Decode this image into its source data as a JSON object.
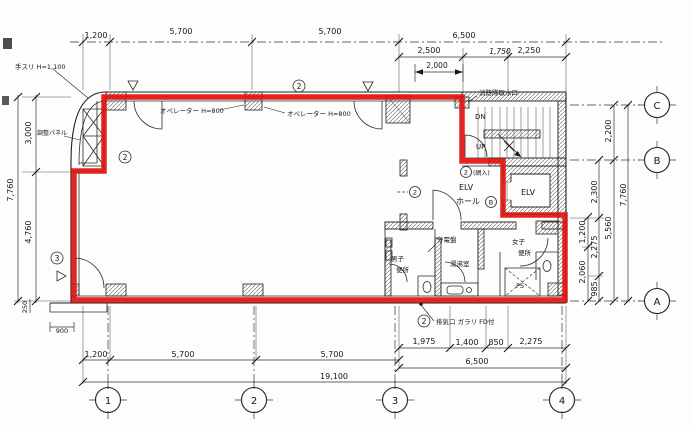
{
  "title": "floor-plan",
  "colors": {
    "leased_outline": "#e0140e",
    "ink": "#1f1f1f"
  },
  "dims": {
    "top": [
      "1,200",
      "5,700",
      "5,700",
      "6,500"
    ],
    "top_sub": [
      "2,500",
      "1,750",
      "2,250"
    ],
    "door_swing": "2,000",
    "left": [
      "3,000",
      "4,760"
    ],
    "left_total": "7,760",
    "step_depth": "250",
    "step_width": "900",
    "bottom_right": [
      "1,975",
      "1,400",
      "850",
      "2,275"
    ],
    "bottom_right_total": "6,500",
    "bottom_left": [
      "1,200",
      "5,700",
      "5,700"
    ],
    "total_width": "19,100",
    "right": {
      "c_to_b": "2,200",
      "upper": "2,300",
      "mid": "1,200",
      "mid2": "2,275",
      "lower": "2,060",
      "lowest": "985",
      "subtotal": "5,560",
      "total": "7,760"
    }
  },
  "grid": {
    "columns": [
      "1",
      "2",
      "3",
      "4"
    ],
    "rows": [
      "C",
      "B",
      "A"
    ]
  },
  "rooms": {
    "elv_hall_line1": "ELV",
    "elv_hall_line2": "ホール",
    "elevator": "ELV",
    "mens_line1": "男子",
    "mens_line2": "便所",
    "womens_line1": "女子",
    "womens_line2": "便所",
    "kitchenette": "湯沸室",
    "pipe_shaft": "PS",
    "stair_down": "DN",
    "stair_up": "UP"
  },
  "annotations": {
    "handrail": "手スリ H=1,100",
    "panel": "調整パネル",
    "operator_left": "オペレーター H=800",
    "operator_right": "オペレーター H=800",
    "fire_intake": "消防隊取水口",
    "distribution_board": "分電盤",
    "exhaust_note": "排気口 ガラリ FD付",
    "wired_glass": "(網入)",
    "mark_2": "2",
    "mark_3": "3",
    "mark_b": "B"
  }
}
